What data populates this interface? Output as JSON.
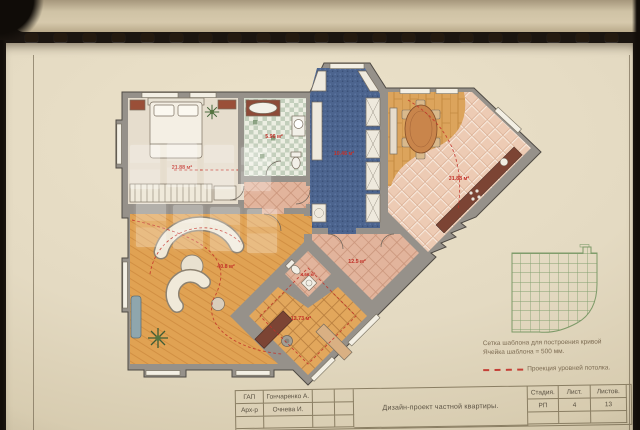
{
  "sheet": {
    "plan": {
      "rooms": [
        {
          "id": "bedroom",
          "area": "21.88 м²"
        },
        {
          "id": "bathroom",
          "area": "5.96 м²"
        },
        {
          "id": "dressing",
          "area": "10.46 м²"
        },
        {
          "id": "kitchen_dining",
          "area": "31.88 м²"
        },
        {
          "id": "living",
          "area": "40.8 м²"
        },
        {
          "id": "hall",
          "area": "12.5 м²"
        },
        {
          "id": "wc",
          "area": "4.66 м²"
        },
        {
          "id": "study",
          "area": "12.73 м²"
        }
      ]
    },
    "legend": {
      "grid_note_line1": "Сетка шаблона для построения кривой",
      "grid_note_line2": "Ячейка шаблона = 500 мм.",
      "ceiling_note": "Проекция уровней потолка."
    },
    "stamp": {
      "role1_label": "ГАП",
      "role1_name": "Гончаренко А.",
      "role2_label": "Арх-р",
      "role2_name": "Очнева И.",
      "project_title": "Дизайн-проект частной квартиры.",
      "stage_label": "Стадия.",
      "stage_value": "РП",
      "sheet_label": "Лист.",
      "sheet_value": "4",
      "sheets_label": "Листов.",
      "sheets_value": "13"
    },
    "colors": {
      "area_label_red": "#c23028",
      "ceiling_dash_red": "#c23028",
      "wall_gray": "#96918a",
      "template_grid_green": "#7d9a68"
    }
  }
}
